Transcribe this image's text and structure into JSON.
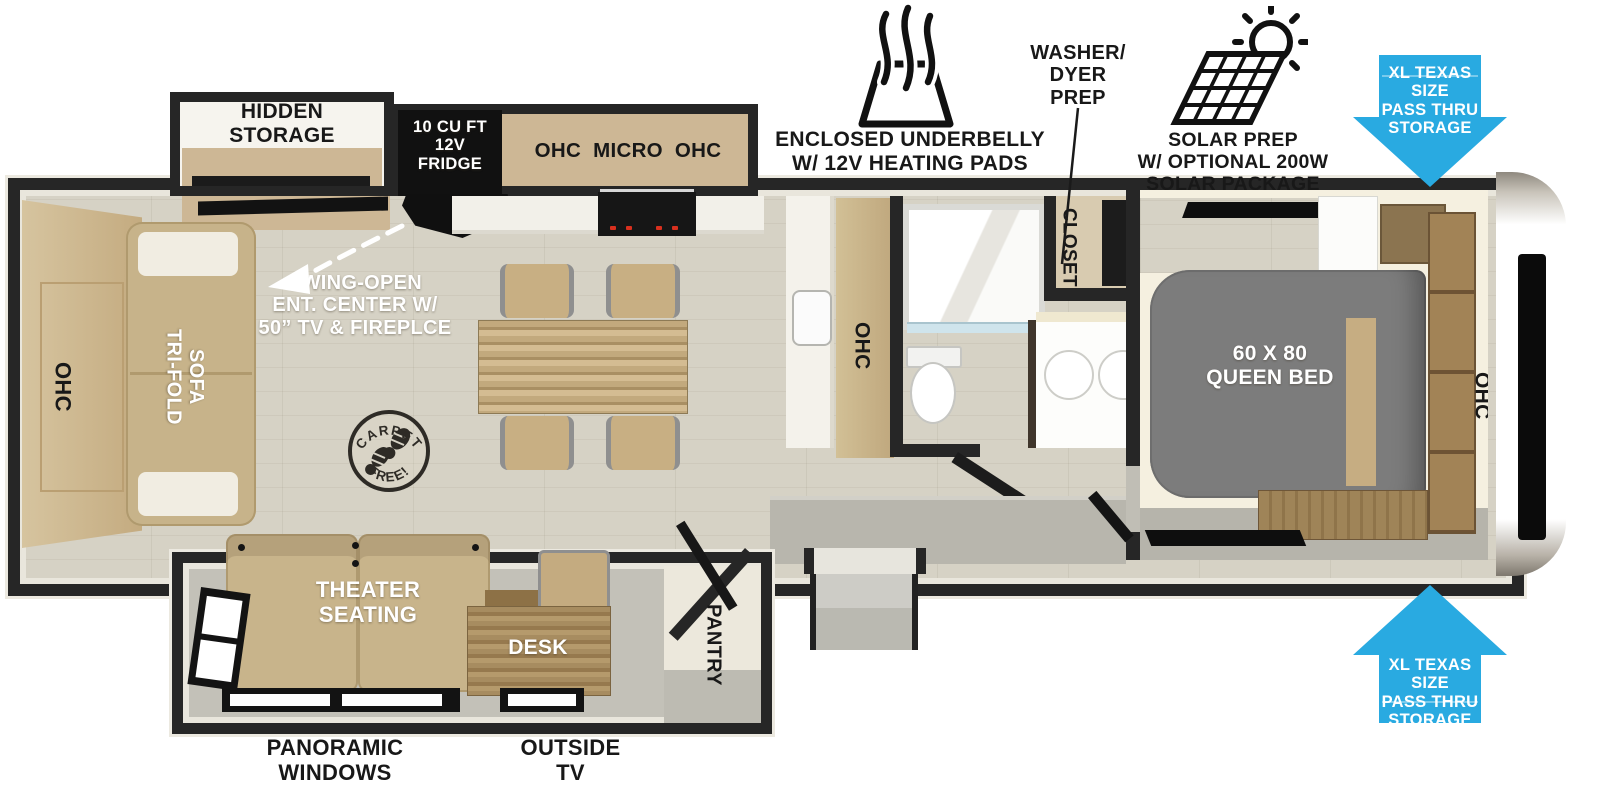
{
  "colors": {
    "arrow_blue": "#29aae1",
    "wall_black": "#262626",
    "bed_gray": "#7c7c7c",
    "cabinet_tan": "#cdb795"
  },
  "callouts": {
    "underbelly": {
      "l1": "ENCLOSED UNDERBELLY",
      "l2": "W/ 12V HEATING PADS"
    },
    "washer_dryer": {
      "l1": "WASHER/",
      "l2": "DYER",
      "l3": "PREP"
    },
    "solar": {
      "l1": "SOLAR PREP",
      "l2": "W/ OPTIONAL 200W",
      "l3": "SOLAR PACKAGE"
    },
    "pass_thru_top": {
      "l1": "XL TEXAS SIZE",
      "l2": "PASS THRU",
      "l3": "STORAGE"
    },
    "pass_thru_bottom": {
      "l1": "XL TEXAS SIZE",
      "l2": "PASS THRU",
      "l3": "STORAGE"
    },
    "panoramic_windows": {
      "l1": "PANORAMIC",
      "l2": "WINDOWS"
    },
    "outside_tv": {
      "l1": "OUTSIDE",
      "l2": "TV"
    }
  },
  "rooms": {
    "hidden_storage": {
      "l1": "HIDDEN",
      "l2": "STORAGE"
    },
    "fridge": {
      "l1": "10 CU FT",
      "l2": "12V",
      "l3": "FRIDGE"
    },
    "kitchen_overhead": "OHC  MICRO  OHC",
    "swing_open": {
      "l1": "SWING-OPEN",
      "l2": "ENT. CENTER W/",
      "l3": "50” TV & FIREPLCE"
    },
    "carpet_stamp": {
      "top": "CARPET",
      "bottom": "FREE!"
    },
    "rear_overhead": "OHC",
    "tri_fold_sofa": {
      "l1": "TRI-FOLD",
      "l2": "SOFA"
    },
    "theater_seating": {
      "l1": "THEATER",
      "l2": "SEATING"
    },
    "desk": "DESK",
    "pantry": "PANTRY",
    "kitchen_counter_overhead": "OHC",
    "closet": "CLOSET",
    "queen_bed": {
      "l1": "60 X 80",
      "l2": "QUEEN BED"
    },
    "bedroom_overhead": "OHC"
  }
}
